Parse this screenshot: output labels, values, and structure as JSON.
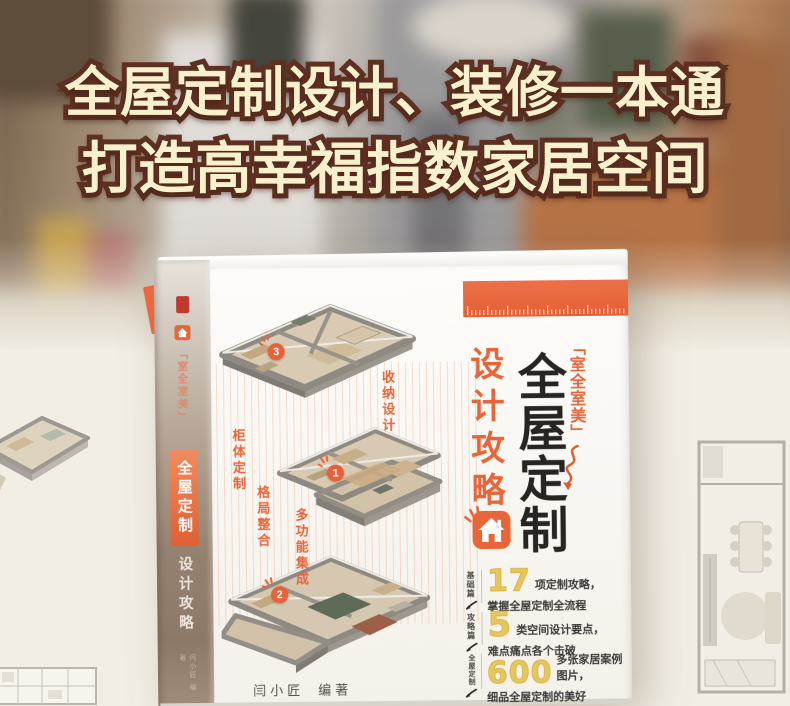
{
  "headline": {
    "line1": "全屋定制设计、装修一本通",
    "line2": "打造高幸福指数家居空间"
  },
  "book": {
    "spine": {
      "series": "「室全室美」",
      "title": "全屋定制",
      "subtitle": "设计攻略",
      "author": "闫小匠 编著"
    },
    "cover": {
      "series": "「室全室美」",
      "title": "全屋定制",
      "subtitle": "设计攻略",
      "author_name": "闫小匠",
      "author_role": "编著",
      "plan_labels": [
        {
          "text": "收纳设计"
        },
        {
          "text": "柜体定制"
        },
        {
          "text": "格局整合"
        },
        {
          "text": "多功能集成"
        }
      ],
      "markers": [
        {
          "num": "3"
        },
        {
          "num": "1"
        },
        {
          "num": "2"
        }
      ],
      "features": [
        {
          "tag": "基础篇",
          "number": "17",
          "line1": "项定制攻略，",
          "line2": "掌握全屋定制全流程"
        },
        {
          "tag": "攻略篇",
          "number": "5",
          "line1": "类空间设计要点，",
          "line2": "难点痛点各个击破"
        },
        {
          "tag": "全屋定制",
          "number": "600",
          "line1": "多张家居案例图片，",
          "line2": "细品全屋定制的美好"
        }
      ]
    }
  },
  "colors": {
    "accent": "#e8653a",
    "headline_fill": "#f9f1cd",
    "headline_outline": "#5e3022",
    "number_yellow": "#e6c65d"
  }
}
